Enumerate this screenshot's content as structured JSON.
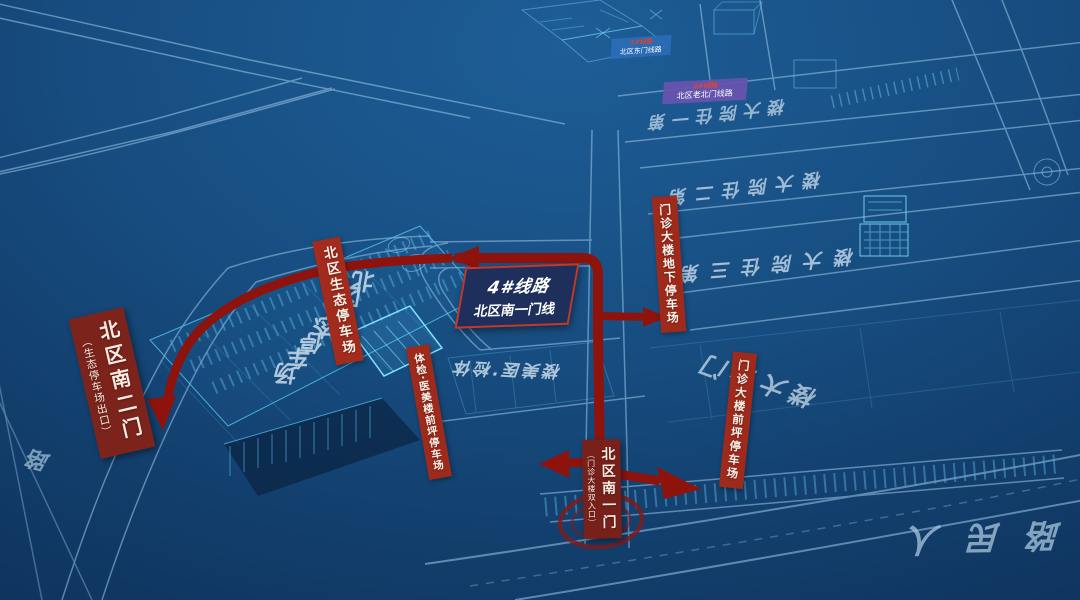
{
  "colors": {
    "route_red": "#8e130d",
    "strip_red": "#9e2a1c",
    "gate_red": "#7c241b",
    "card_navy": "#1d2f5a",
    "card_border": "#c0392b",
    "ground_text": "#d5e5f2",
    "renmin_text": "#a9c6db",
    "road_line": "#9cc8ea",
    "wire_cyan": "#55c8f5",
    "mini_blue": "#2a6cb6",
    "mini_purple": "#6852b0"
  },
  "route_card": {
    "line1": "4#线路",
    "line2": "北区南一门线"
  },
  "mini_cards": {
    "east": {
      "line1": "3#线路",
      "line2": "北区东门线路"
    },
    "north": {
      "line1": "2#线路",
      "line2": "北区老北门线路"
    }
  },
  "gates": {
    "south2": {
      "main": "北区南二门",
      "sub": "（生态停车场出口）"
    },
    "south1": {
      "main": "北区南一门",
      "sub": "（门诊大楼双入口）"
    }
  },
  "parking": {
    "eco": "北区生态停车场",
    "tijian": "体检·医美楼前坪停车场",
    "underground": "门诊大楼地下停车场",
    "front": "门诊大楼前坪停车场"
  },
  "ground": {
    "ward1": "第一住院大楼",
    "ward2": "第二住院大楼",
    "ward3": "第三住院大楼",
    "outpatient": "门诊大楼",
    "tijian": "体检·医美楼",
    "eco_parking": "北区生态停车场",
    "renmin_road": "人民路",
    "road_partial": "路"
  }
}
